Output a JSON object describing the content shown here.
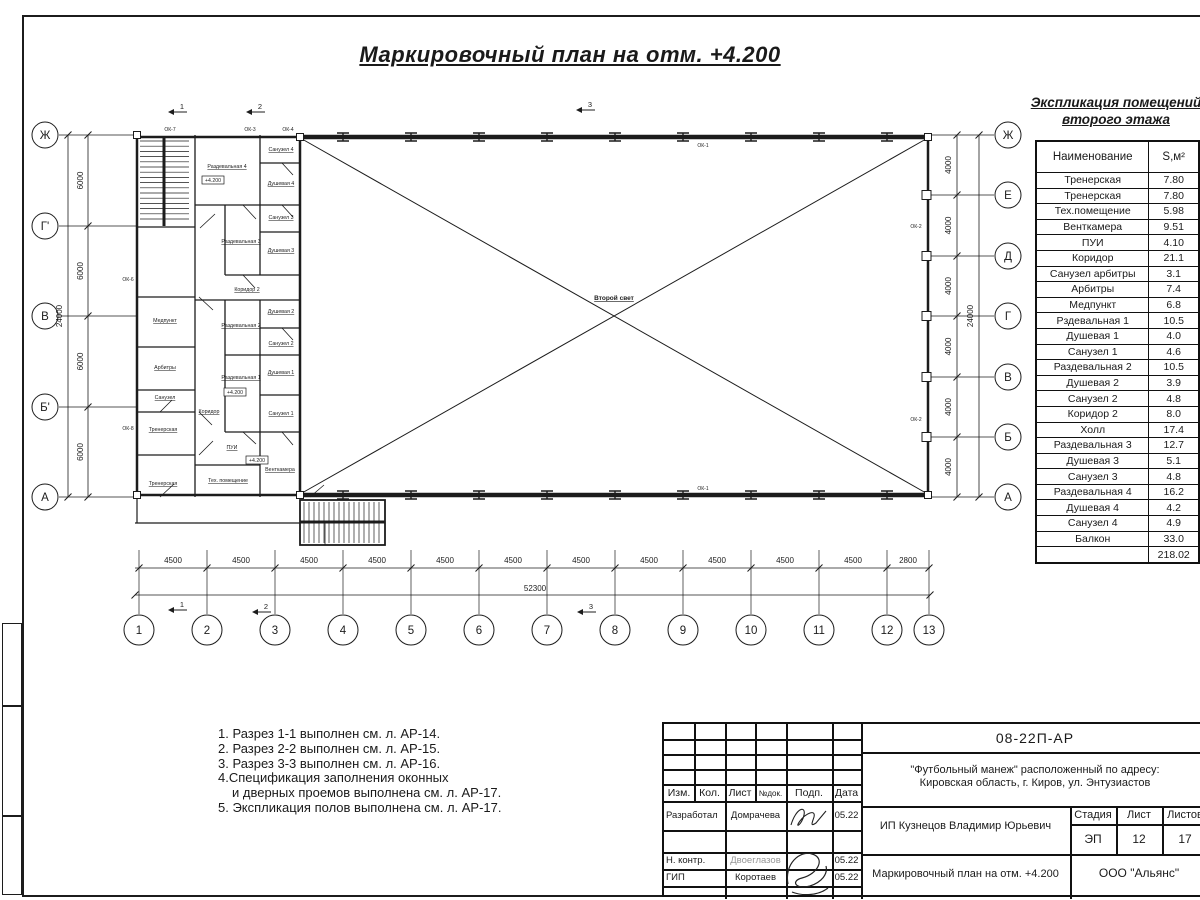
{
  "sheet": {
    "title": "Маркировочный план на отм. +4.200"
  },
  "room_table": {
    "title_line1": "Экспликация помещений",
    "title_line2": "второго этажа",
    "col_name": "Наименование",
    "col_area": "S,м²",
    "rows": [
      {
        "name": "Тренерская",
        "area": "7.80"
      },
      {
        "name": "Тренерская",
        "area": "7.80"
      },
      {
        "name": "Тех.помещение",
        "area": "5.98"
      },
      {
        "name": "Венткамера",
        "area": "9.51"
      },
      {
        "name": "ПУИ",
        "area": "4.10"
      },
      {
        "name": "Коридор",
        "area": "21.1"
      },
      {
        "name": "Санузел арбитры",
        "area": "3.1"
      },
      {
        "name": "Арбитры",
        "area": "7.4"
      },
      {
        "name": "Медпункт",
        "area": "6.8"
      },
      {
        "name": "Рздевальная 1",
        "area": "10.5"
      },
      {
        "name": "Душевая 1",
        "area": "4.0"
      },
      {
        "name": "Санузел 1",
        "area": "4.6"
      },
      {
        "name": "Раздевальная 2",
        "area": "10.5"
      },
      {
        "name": "Душевая 2",
        "area": "3.9"
      },
      {
        "name": "Санузел 2",
        "area": "4.8"
      },
      {
        "name": "Коридор 2",
        "area": "8.0"
      },
      {
        "name": "Холл",
        "area": "17.4"
      },
      {
        "name": "Раздевальная 3",
        "area": "12.7"
      },
      {
        "name": "Душевая 3",
        "area": "5.1"
      },
      {
        "name": "Санузел 3",
        "area": "4.8"
      },
      {
        "name": "Раздевальная 4",
        "area": "16.2"
      },
      {
        "name": "Душевая 4",
        "area": "4.2"
      },
      {
        "name": "Санузел 4",
        "area": "4.9"
      },
      {
        "name": "Балкон",
        "area": "33.0"
      },
      {
        "name": "",
        "area": "218.02"
      }
    ]
  },
  "notes": {
    "lines": [
      "1. Разрез 1-1 выполнен см. л. АР-14.",
      "2. Разрез 2-2 выполнен см. л. АР-15.",
      "3. Разрез 3-3 выполнен см. л. АР-16.",
      "4.Спецификация заполнения оконных",
      "и дверных проемов выполнена см. л. АР-17.",
      "5. Экспликация полов выполнена см. л. АР-17."
    ]
  },
  "plan": {
    "axes_left": {
      "labels": [
        "Ж",
        "Г'",
        "В",
        "Б'",
        "А"
      ],
      "dims": [
        "6000",
        "6000",
        "6000",
        "6000"
      ],
      "total": "24000"
    },
    "axes_right": {
      "labels": [
        "Ж",
        "Е",
        "Д",
        "Г",
        "В",
        "Б",
        "А"
      ],
      "dims": [
        "4000",
        "4000",
        "4000",
        "4000",
        "4000",
        "4000"
      ],
      "total": "24000"
    },
    "axes_bottom": {
      "labels": [
        "1",
        "2",
        "3",
        "4",
        "5",
        "6",
        "7",
        "8",
        "9",
        "10",
        "11",
        "12",
        "13"
      ],
      "dims": [
        "4500",
        "4500",
        "4500",
        "4500",
        "4500",
        "4500",
        "4500",
        "4500",
        "4500",
        "4500",
        "4500",
        "2800"
      ],
      "total": "52300"
    },
    "section_markers": [
      "1",
      "2",
      "3"
    ],
    "hall_label": "Второй свет",
    "elevation_mark": "+4.200",
    "window_marks": [
      "ОК-1",
      "ОК-2",
      "ОК-3",
      "ОК-4",
      "ОК-6",
      "ОК-7",
      "ОК-8"
    ],
    "room_labels": [
      "Раздевальная 4",
      "Санузел 4",
      "Душевая 4",
      "Санузел 3",
      "Душевая 3",
      "Раздевальная 3",
      "Коридор 2",
      "Медпункт",
      "Душевая 2",
      "Раздевальная 2",
      "Санузел 2",
      "Арбитры",
      "Санузел",
      "Коридор",
      "Раздевальная 1",
      "Душевая 1",
      "Санузел 1",
      "Тренерская",
      "ПУИ",
      "Тех. помещение",
      "Тренерская",
      "Венткамера"
    ]
  },
  "title_block": {
    "doc_code": "08-22П-АР",
    "project_line1": "\"Футбольный манеж\" расположенный по адресу:",
    "project_line2": "Кировская область, г. Киров, ул. Энтузиастов",
    "client": "ИП Кузнецов Владимир Юрьевич",
    "sheet_name": "Маркировочный план на отм. +4.200",
    "company": "ООО \"Альянс\"",
    "header_cols": [
      "Изм.",
      "Кол.",
      "Лист",
      "№док.",
      "Подп.",
      "Дата"
    ],
    "stage_label": "Стадия",
    "sheet_label": "Лист",
    "sheets_label": "Листов",
    "stage": "ЭП",
    "sheet_no": "12",
    "sheets_total": "17",
    "roles": [
      {
        "role": "Разработал",
        "name": "Домрачева",
        "date": "05.22"
      },
      {
        "role": "Н. контр.",
        "name": "Двоеглазов",
        "date": "05.22"
      },
      {
        "role": "ГИП",
        "name": "Коротаев",
        "date": "05.22"
      }
    ]
  }
}
